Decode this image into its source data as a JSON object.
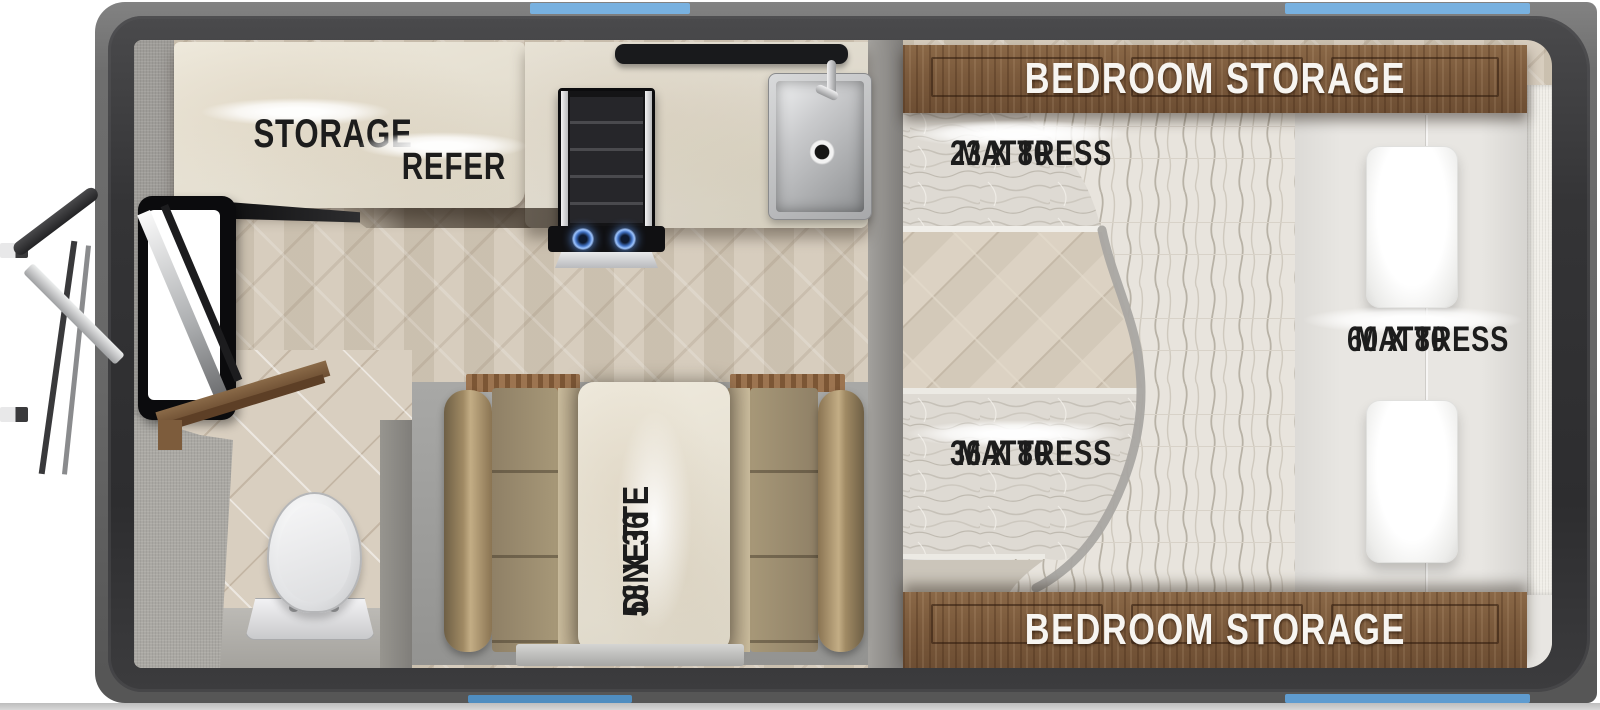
{
  "labels": {
    "storage": "STORAGE",
    "refer": "REFER",
    "dinette": {
      "line1": "58 X 36",
      "line2": "DINETTE"
    },
    "mattress_23": {
      "line1": "23 X 80",
      "line2": "MATTRESS"
    },
    "mattress_36": {
      "line1": "36 X 80",
      "line2": "MATTRESS"
    },
    "mattress_60": {
      "line1": "60 X 80",
      "line2": "MATTRESS"
    },
    "bedroom_storage_top": "BEDROOM STORAGE",
    "bedroom_storage_bottom": "BEDROOM STORAGE"
  },
  "colors": {
    "window_blue": "#78b1e0",
    "body_gray": "#6a6a6a",
    "wall_dark": "#323234",
    "cabinet_wood": "#7b5a3c",
    "counter_marble": "#e9e4d7",
    "cushion_tan": "#a2937a",
    "floor_wood": "#d0c6b6",
    "mattress_white": "#e8e6e2"
  },
  "fixtures": [
    "entry-door",
    "entry-steps",
    "storage-counter",
    "refrigerator",
    "cooktop-burners",
    "kitchen-sink",
    "faucet",
    "overhead-shelf",
    "bathroom-shelf",
    "toilet",
    "dinette-table",
    "dinette-bench-left",
    "dinette-bench-right",
    "bed-mattress-60x80",
    "bed-mattress-36x80",
    "bed-mattress-23x80",
    "pillow",
    "bedroom-storage-cabinet-top",
    "bedroom-storage-cabinet-bottom",
    "window-top-center",
    "window-top-right",
    "window-bottom-center",
    "window-bottom-right"
  ]
}
